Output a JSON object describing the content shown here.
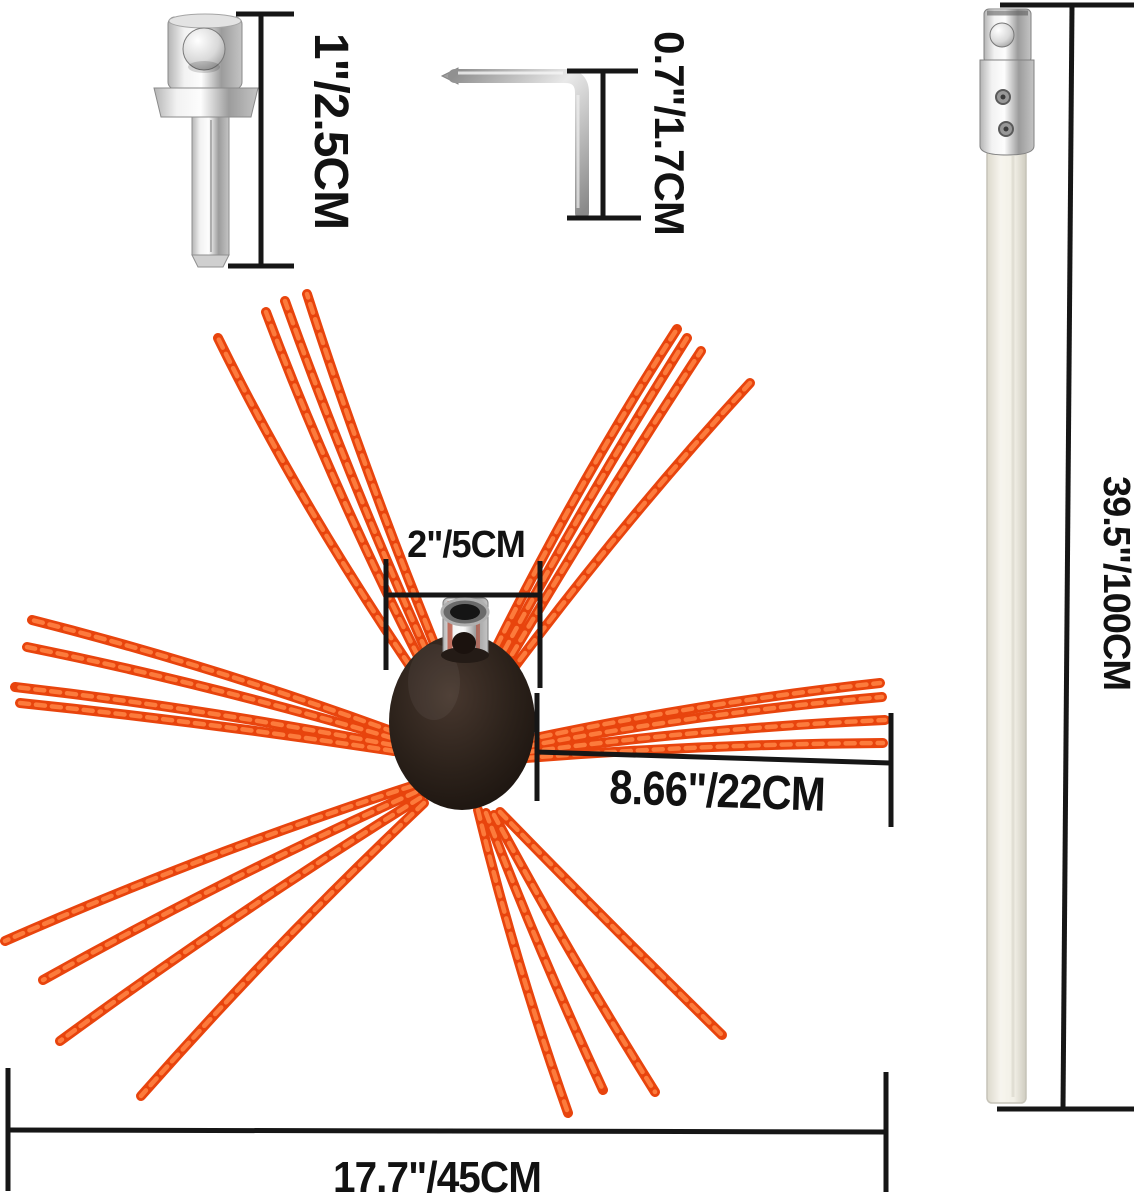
{
  "dimensions": {
    "adapter": "1\"/2.5CM",
    "hex_key": "0.7\"/1.7CM",
    "rod": "39.5\"/100CM",
    "hub_width": "2\"/5CM",
    "bristle_length": "8.66\"/22CM",
    "brush_diameter": "17.7\"/45CM"
  },
  "colors": {
    "background": "#ffffff",
    "dimension_line": "#161616",
    "text": "#121212",
    "bristle": "#e8440d",
    "bristle_highlight": "#ff8142",
    "hub": "#241b16",
    "rod_white": "#f1efe6",
    "metal": "#c9c9c9"
  }
}
